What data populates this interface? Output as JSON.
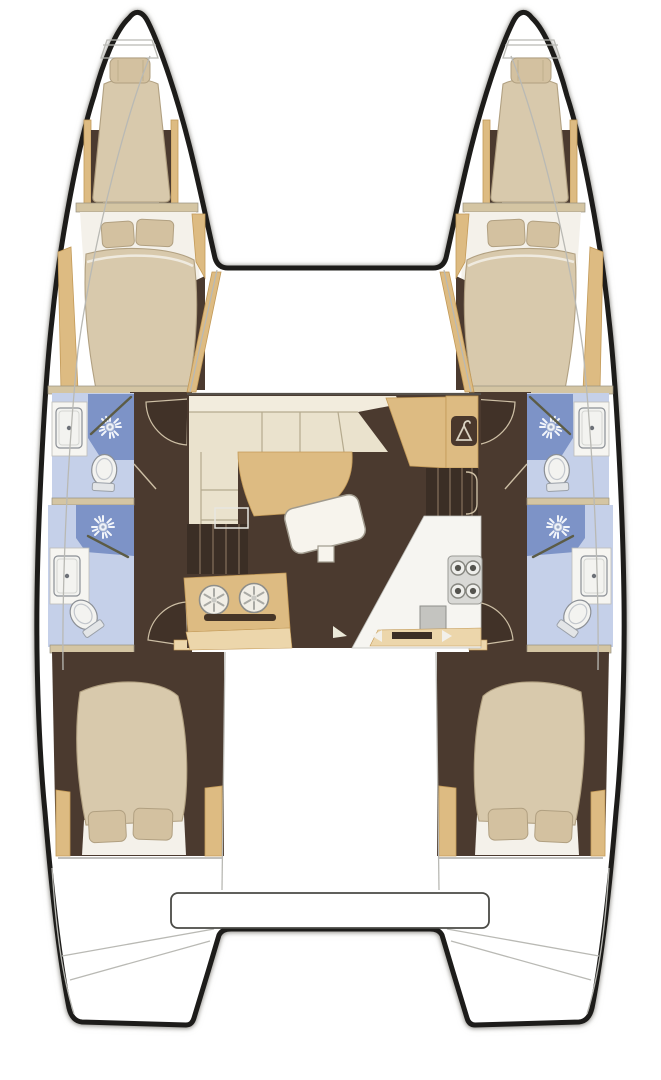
{
  "diagram": {
    "title": "Catamaran interior layout floor plan, top view, bow up",
    "type": "boat-floor-plan",
    "hulls": 2,
    "cabins": 4,
    "heads": 4,
    "symmetry": "port and starboard hulls mirrored"
  },
  "palette": {
    "paper": "#ffffff",
    "outline": "#1d1c1a",
    "shadow": "rgba(120,118,112,0.55)",
    "floor_brown": "#4b3a2f",
    "steps_dark": "#3b2e25",
    "step_line": "#74614f",
    "wood": "#ddbb82",
    "wood_light": "#ecd6ab",
    "wood_edge": "#c39a58",
    "bulkhead": "#d4c5a3",
    "mattress": "#d8c9ac",
    "mattress_edge": "#b1a081",
    "pillow": "#d3c1a0",
    "sheet": "#f4f1ea",
    "bath_floor": "#c5d0e9",
    "shower": "#7d93c7",
    "fixture": "#f3f3f0",
    "fixture_edge": "#8c9096",
    "sofa": "#eae2cd",
    "sofa_back": "#f2ecdd",
    "sofa_line": "#b5aa8e",
    "counter": "#f6f5f1",
    "appliance": "#d9d9d6",
    "burner": "#55544f",
    "door_line": "#cdbfa5",
    "shower_rod": "#5c5c46",
    "deck_line": "#b9b9b4",
    "wardrobe_box": "#4a382c",
    "hanger_glyph": "#d9d2c2"
  },
  "rooms": {
    "each_hull_bow_to_stern": [
      "anchor locker",
      "forepeak single berth with pillow",
      "forward double berth cabin",
      "forward head: shower stall, sink counter, toilet",
      "aft shower room: shower stall, sink counter, toilet",
      "companionway corridor with doors",
      "aft double cabin with two pillows",
      "transom swim steps"
    ],
    "salon": [
      "L-shaped settee with cushions",
      "curved dining table",
      "rotated coffee table",
      "chart desk with wardrobe locker (hanger icon)",
      "galley unit with twin round sinks and drawer slot",
      "galley counter with 4-burner stove and square sink",
      "companionway steps down to port hull",
      "companionway steps down to starboard hull",
      "sliding-door indicator to cockpit"
    ],
    "exterior": [
      "bow trampoline area between hulls",
      "aft cockpit bench between hulls",
      "twin transoms"
    ]
  },
  "icons": {
    "shower-head-icon": "white sunburst on blue shower floor",
    "toilet-icon": "oval bowl with tank",
    "sink-icon": "rounded rectangle with drain dot",
    "drain-sink-icon": "circle with six spokes",
    "burner-icon": "double circle",
    "hanger-icon": "clothes hanger in dark rounded square",
    "door-swing-icon": "quarter-circle arc"
  }
}
